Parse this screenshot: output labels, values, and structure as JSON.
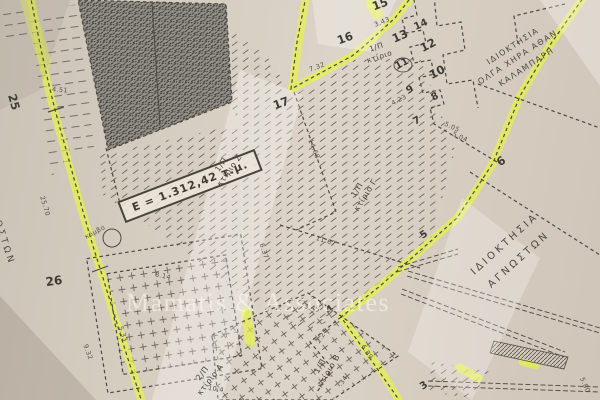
{
  "watermark": "Mamatis & Associates",
  "area_box": {
    "label": "E = 1.312,42 τ.μ."
  },
  "properties": {
    "kalampari": {
      "line1": "ΙΔΙΟΚΤΗΣΙΑ",
      "line2": "ΟΛΓΑ ΧΗΡΑ ΑΘΑΝ.",
      "line3": "ΚΑΛΑΜΠΑΡΗ"
    },
    "unknown_right": {
      "line1": "ΙΔΙΟΚΤΗΣΙΑ",
      "line2": "ΑΓΝΩΣΤΩΝ"
    },
    "unknown_left": {
      "line1": "ΑΓΝΩΣΤΩΝ"
    }
  },
  "buildings": {
    "top": {
      "line1": "1/Π",
      "line2": "κτίριο"
    },
    "z": {
      "line1": "1/Π",
      "line2": "κτίριο Ζ"
    },
    "g": {
      "line1": "1/Π",
      "line2": "κτίριο Γ"
    },
    "a": {
      "line1": "2/Π",
      "line2": "κτίριο Α"
    },
    "b": {
      "line1": "1/Π",
      "line2": "κτίριο Β"
    }
  },
  "annotations": {
    "node": "κόμβο"
  },
  "point_labels": {
    "p3": "3",
    "p4": "4",
    "p5": "5",
    "p6": "6",
    "p7": "7",
    "p8": "8",
    "p9": "9",
    "p10": "10",
    "p11": "11",
    "p12": "12",
    "p13": "13",
    "p14": "14",
    "p15": "15",
    "p16": "16",
    "p17": "17",
    "p25": "25",
    "p26": "26"
  },
  "dimensions": {
    "seg_25_26": "25.70",
    "left_lower": "9.32",
    "left_bottom": "5.33",
    "top_left": "4.51",
    "building_a_side": "8.14",
    "building_a_bottom": "10.4",
    "parcel_west": "14.68",
    "parcel_vert": "6.37",
    "parcel_diag": "11.67",
    "parcel_south": "3.45",
    "stair_upper": "3.43",
    "stair_mid": "4.23",
    "seg_7_6_a": "5.05",
    "seg_7_6_b": "5.04",
    "seg_16_17": "7.32",
    "seg_4_3": "6.89",
    "seg_4_side": "2.27",
    "seg_b_side": ".34",
    "bottom_right": "5.80"
  },
  "colors": {
    "highlighter": "#e8f542",
    "paper": "#d8cfc4",
    "ink": "#4c4944",
    "watermark_text": "#f7f4ec"
  }
}
